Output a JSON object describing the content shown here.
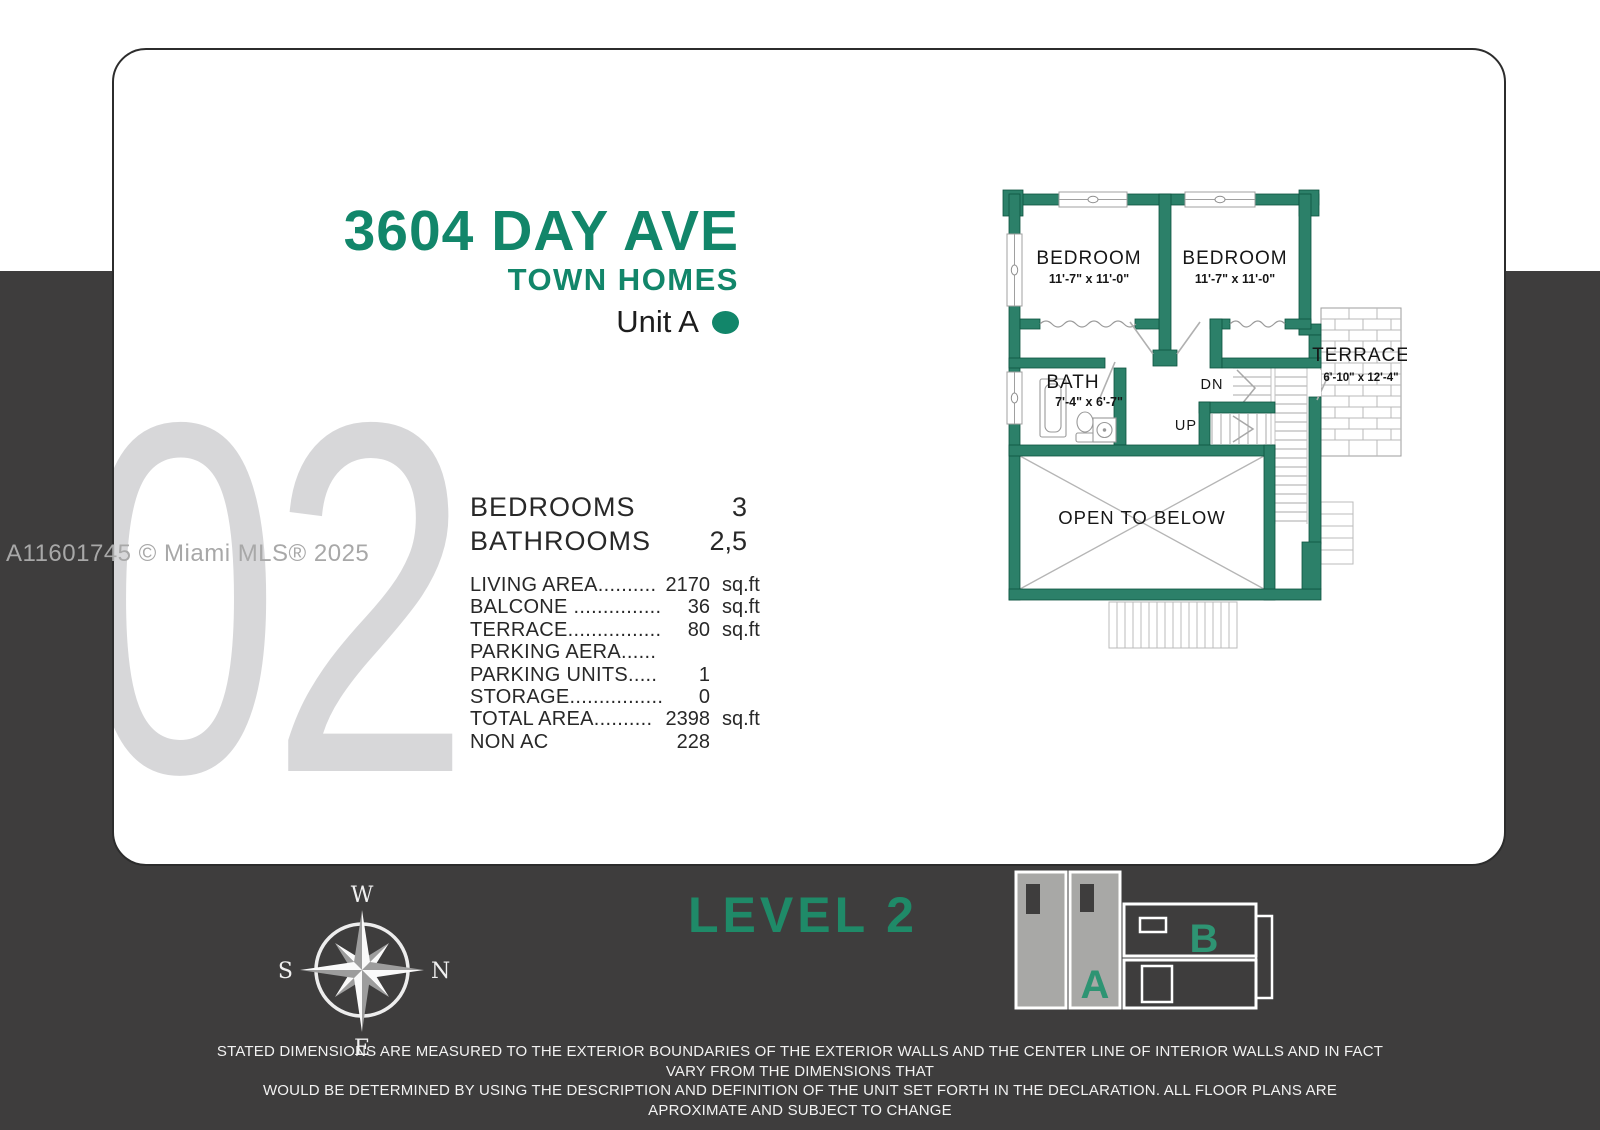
{
  "header": {
    "address": "3604 DAY AVE",
    "subtitle": "TOWN HOMES",
    "unit": "Unit A"
  },
  "watermarks": {
    "page_number": "02",
    "mls": "A11601745 © Miami MLS® 2025"
  },
  "stats": {
    "primary": [
      {
        "label": "BEDROOMS",
        "value": "3"
      },
      {
        "label": "BATHROOMS",
        "value": "2,5"
      }
    ],
    "details": [
      {
        "label": "LIVING AREA..........",
        "value": "2170",
        "unit": "sq.ft"
      },
      {
        "label": "BALCONE ...............",
        "value": "36",
        "unit": "sq.ft"
      },
      {
        "label": "TERRACE................",
        "value": "80",
        "unit": "sq.ft"
      },
      {
        "label": "PARKING AERA......",
        "value": "",
        "unit": ""
      },
      {
        "label": "PARKING UNITS.....",
        "value": "1",
        "unit": ""
      },
      {
        "label": "STORAGE................",
        "value": "0",
        "unit": ""
      },
      {
        "label": "TOTAL AREA..........",
        "value": "2398",
        "unit": "sq.ft"
      },
      {
        "label": "NON AC",
        "value": "228",
        "unit": ""
      }
    ]
  },
  "floorplan": {
    "bedroom1": {
      "name": "BEDROOM",
      "dims": "11'-7\" x 11'-0\""
    },
    "bedroom2": {
      "name": "BEDROOM",
      "dims": "11'-7\" x 11'-0\""
    },
    "bath": {
      "name": "BATH",
      "dims": "7'-4\" x 6'-7\""
    },
    "terrace": {
      "name": "TERRACE",
      "dims": "6'-10\" x 12'-4\""
    },
    "open_below": "OPEN TO BELOW",
    "stairs": {
      "down": "DN",
      "up": "UP"
    }
  },
  "footer": {
    "level": "LEVEL 2",
    "compass": {
      "top": "W",
      "right": "N",
      "bottom": "E",
      "left": "S"
    },
    "siteplan": {
      "unit_a": "A",
      "unit_b": "B"
    },
    "disclaimer_line1": "STATED DIMENSIONS ARE MEASURED TO THE EXTERIOR BOUNDARIES OF THE EXTERIOR WALLS AND THE CENTER LINE OF INTERIOR WALLS AND IN FACT VARY FROM THE DIMENSIONS THAT",
    "disclaimer_line2": "WOULD BE DETERMINED BY USING THE DESCRIPTION AND DEFINITION OF THE UNIT SET FORTH IN THE DECLARATION.  ALL FLOOR PLANS ARE APROXIMATE AND SUBJECT TO CHANGE"
  },
  "colors": {
    "accent_green": "#12866a",
    "wall_green": "#2c8069",
    "background_dark": "#3e3d3d",
    "watermark_gray": "#d7d7d9",
    "site_gray": "#a8a8a6"
  }
}
